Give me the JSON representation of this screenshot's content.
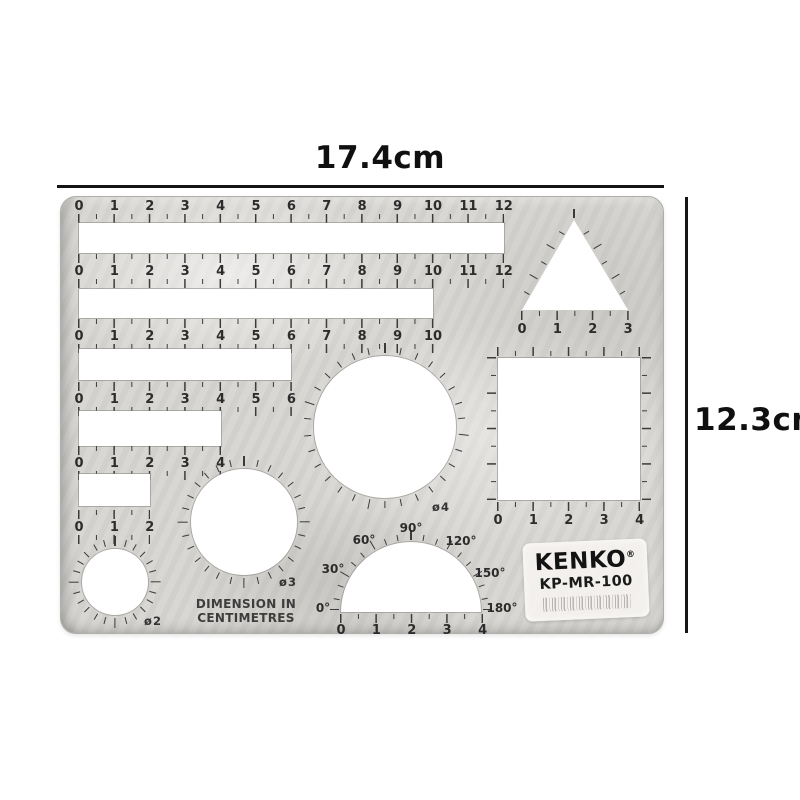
{
  "annotations": {
    "width_label": "17.4cm",
    "height_label": "12.3cm"
  },
  "colors": {
    "plastic": "#d7d5d1",
    "cutout": "#ffffff",
    "tick": "#3b3b3b",
    "annotation": "#151515",
    "label_bg": "#f5f3ef",
    "brand_text": "#131313"
  },
  "template": {
    "cm": 35.4,
    "origin_x": 18,
    "note_line1": "DIMENSION IN",
    "note_line2": "CENTIMETRES",
    "brand": {
      "name": "KENKO",
      "reg": "®",
      "model": "KP-MR-100"
    },
    "rulers": [
      {
        "numbers": [
          0,
          1,
          2,
          3,
          4,
          5,
          6,
          7,
          8,
          9,
          10,
          11,
          12
        ],
        "slot_cm": 12,
        "y_num": 3,
        "y_slot": 26,
        "slot_h": 30,
        "above": false
      },
      {
        "numbers": [
          0,
          1,
          2,
          3,
          4,
          5,
          6,
          7,
          8,
          9,
          10,
          11,
          12
        ],
        "slot_cm": 10,
        "y_num": 68,
        "y_slot": 92,
        "slot_h": 29,
        "above": true
      },
      {
        "numbers": [
          0,
          1,
          2,
          3,
          4,
          5,
          6,
          7,
          8,
          9,
          10
        ],
        "slot_cm": 6,
        "y_num": 133,
        "y_slot": 152,
        "slot_h": 31,
        "above": true
      },
      {
        "numbers": [
          0,
          1,
          2,
          3,
          4,
          5,
          6
        ],
        "slot_cm": 4,
        "y_num": 196,
        "y_slot": 214,
        "slot_h": 35,
        "above": true
      },
      {
        "numbers": [
          0,
          1,
          2,
          3,
          4
        ],
        "slot_cm": 2,
        "y_num": 260,
        "y_slot": 277,
        "slot_h": 32,
        "above": true
      },
      {
        "numbers": [
          0,
          1,
          2
        ],
        "slot_cm": 0,
        "y_num": 324,
        "y_slot": 0,
        "slot_h": 0,
        "above": true
      }
    ],
    "circles": [
      {
        "label": "ø4",
        "cx": 324,
        "cy": 230,
        "r": 71,
        "ticks": 30,
        "lx": 380,
        "ly": 310
      },
      {
        "label": "ø3",
        "cx": 183,
        "cy": 325,
        "r": 53,
        "ticks": 28,
        "lx": 227,
        "ly": 385
      },
      {
        "label": "ø2",
        "cx": 54,
        "cy": 385,
        "r": 33,
        "ticks": 24,
        "lx": 92,
        "ly": 424
      }
    ],
    "triangle": {
      "apex_x": 513,
      "apex_y": 23,
      "base_y": 113,
      "base_x0": 461,
      "base_x1": 567,
      "numbers": [
        0,
        1,
        2,
        3
      ]
    },
    "square": {
      "x": 437,
      "y": 161,
      "size_cm": 4,
      "numbers": [
        0,
        1,
        2,
        3,
        4
      ]
    },
    "protractor": {
      "cx": 350,
      "cy": 415,
      "r": 70,
      "deg_labels": [
        {
          "text": "0°",
          "x": 262,
          "y": 411
        },
        {
          "text": "30°",
          "x": 272,
          "y": 372
        },
        {
          "text": "60°",
          "x": 303,
          "y": 343
        },
        {
          "text": "90°",
          "x": 350,
          "y": 331
        },
        {
          "text": "120°",
          "x": 400,
          "y": 344
        },
        {
          "text": "150°",
          "x": 429,
          "y": 376
        },
        {
          "text": "180°",
          "x": 441,
          "y": 411
        }
      ],
      "numbers": [
        0,
        1,
        2,
        3,
        4
      ]
    }
  }
}
